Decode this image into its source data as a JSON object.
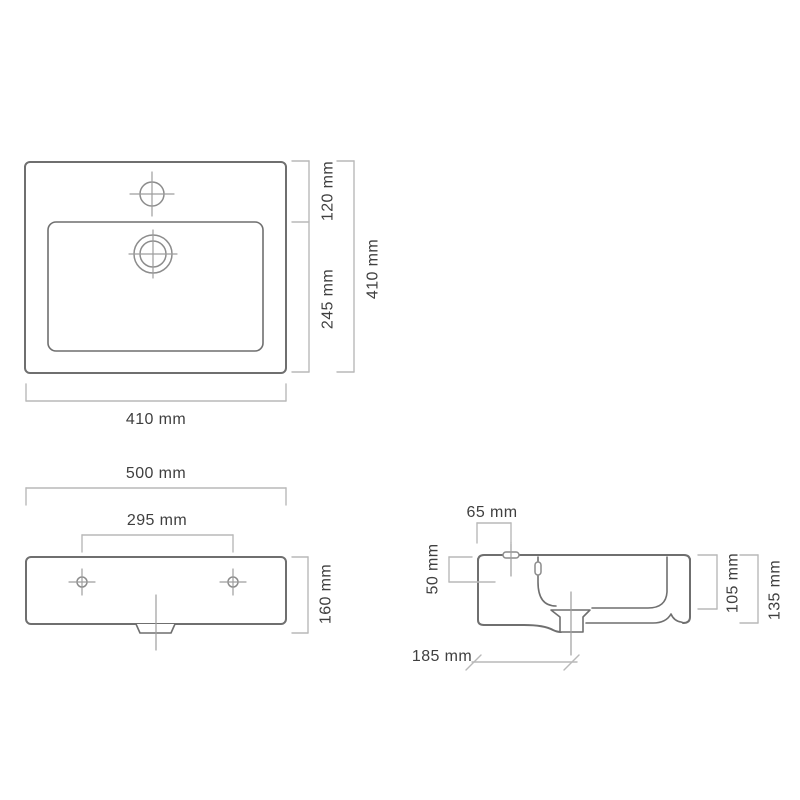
{
  "diagram": {
    "title": "washbasin-dimension-drawing",
    "unit": "mm",
    "colors": {
      "background": "#ffffff",
      "outline": "#6f6f6f",
      "detail": "#8c8c8c",
      "centerline": "#9e9e9e",
      "dimension": "#b9b9b9",
      "text": "#3f3f3f"
    },
    "top_view": {
      "label_rim_depth": "120 mm",
      "label_basin_depth": "245 mm",
      "label_total_depth": "410 mm",
      "label_total_width": "410 mm"
    },
    "front_view": {
      "label_total_width": "500 mm",
      "label_hole_spacing": "295 mm",
      "label_height": "160 mm"
    },
    "side_view": {
      "label_faucet_offset": "65 mm",
      "label_overflow_height": "50 mm",
      "label_basin_depth": "105 mm",
      "label_total_height": "135 mm",
      "label_drain_offset": "185 mm"
    }
  }
}
